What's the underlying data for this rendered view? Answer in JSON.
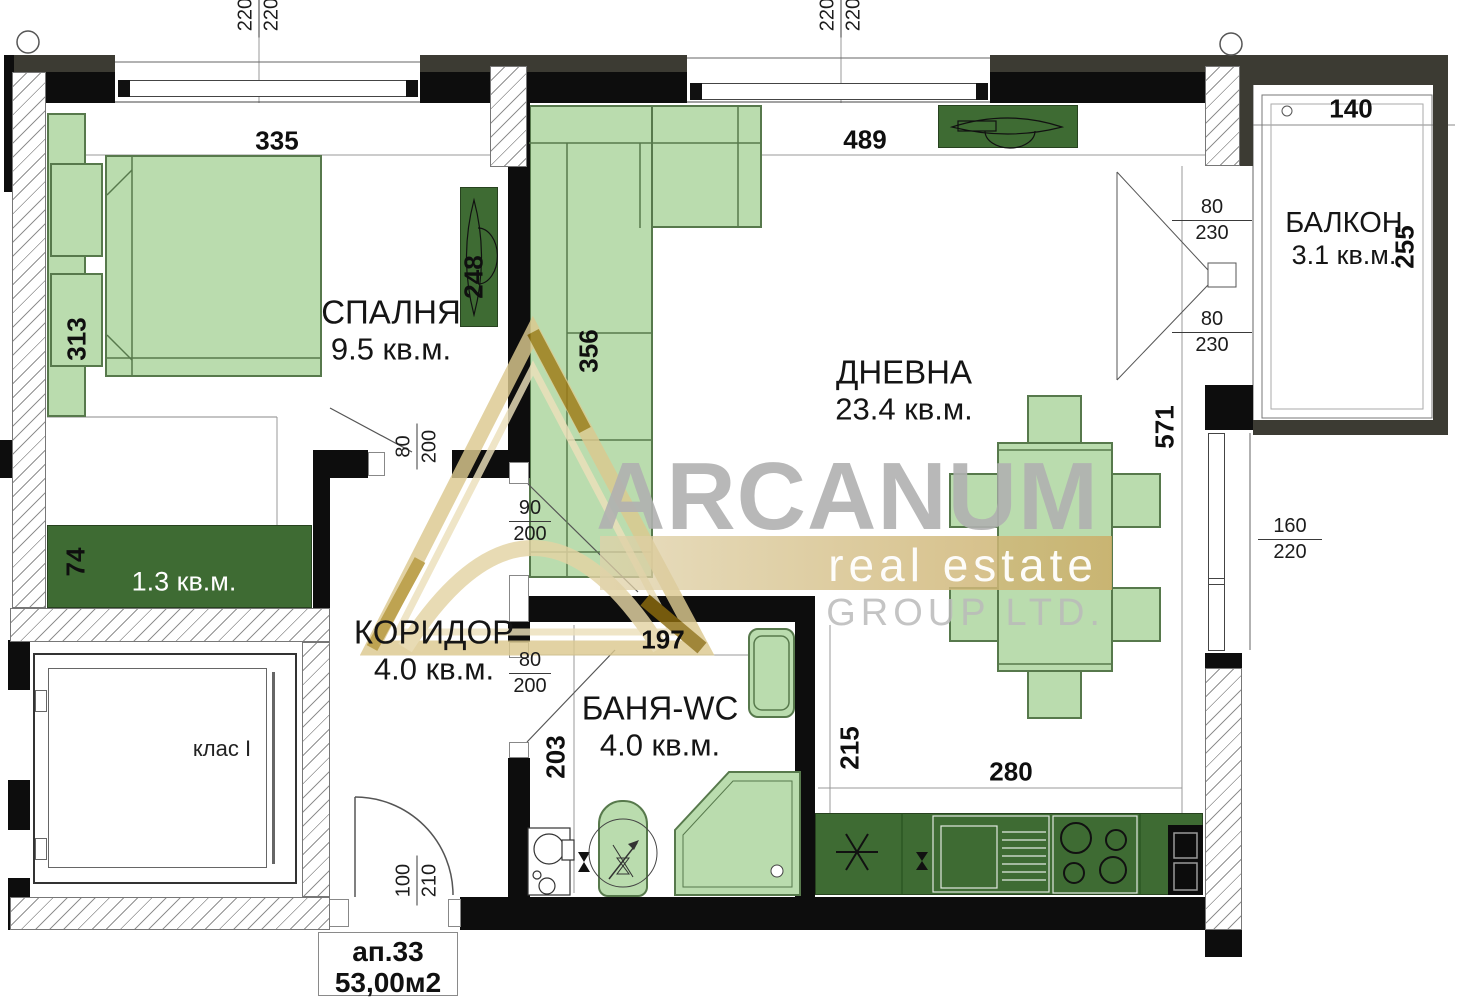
{
  "title": "Apartment floor plan",
  "watermark": {
    "brand": "ARCANUM",
    "tagline": "real estate",
    "subtitle": "GROUP LTD."
  },
  "stamp": {
    "apartment": "ап.33",
    "area": "53,00м2"
  },
  "rooms": {
    "bedroom": {
      "name": "СПАЛНЯ",
      "area": "9.5 кв.м."
    },
    "living": {
      "name": "ДНЕВНА",
      "area": "23.4 кв.м."
    },
    "corridor": {
      "name": "КОРИДОР",
      "area": "4.0 кв.м."
    },
    "bathroom": {
      "name": "БАНЯ-WC",
      "area": "4.0 кв.м."
    },
    "balcony": {
      "name": "БАЛКОН",
      "area": "3.1 кв.м."
    },
    "wardrobe": {
      "area": "1.3 кв.м."
    },
    "elevator": {
      "label": "клас I"
    }
  },
  "dims": {
    "bedroom_width": "335",
    "living_width": "489",
    "balcony_width": "140",
    "bed": "313",
    "tv_cabinet": "248",
    "sofa": "356",
    "living_depth": "571",
    "balcony_depth": "255",
    "wardrobe_depth": "74",
    "bath_width": "197",
    "bath_depth": "203",
    "kitchen_depth": "215",
    "kitchen_width": "280",
    "window1": {
      "a": "220",
      "b": "220"
    },
    "window2": {
      "a": "220",
      "b": "220"
    },
    "balcony_door_top": {
      "w": "80",
      "h": "230"
    },
    "balcony_door_bottom": {
      "w": "80",
      "h": "230"
    },
    "side_window": {
      "w": "160",
      "h": "220"
    },
    "bedroom_door": {
      "w": "80",
      "h": "200"
    },
    "living_opening": {
      "w": "90",
      "h": "200"
    },
    "bath_door": {
      "w": "80",
      "h": "200"
    },
    "entry_door": {
      "w": "100",
      "h": "210"
    }
  },
  "colors": {
    "furniture_light": "#badcae",
    "furniture_dark": "#3e6b33",
    "wall": "#0d0d0d",
    "wall_accent": "#3c3b33",
    "watermark_gold": "#d8c287",
    "watermark_gray": "#b3b3b3"
  }
}
